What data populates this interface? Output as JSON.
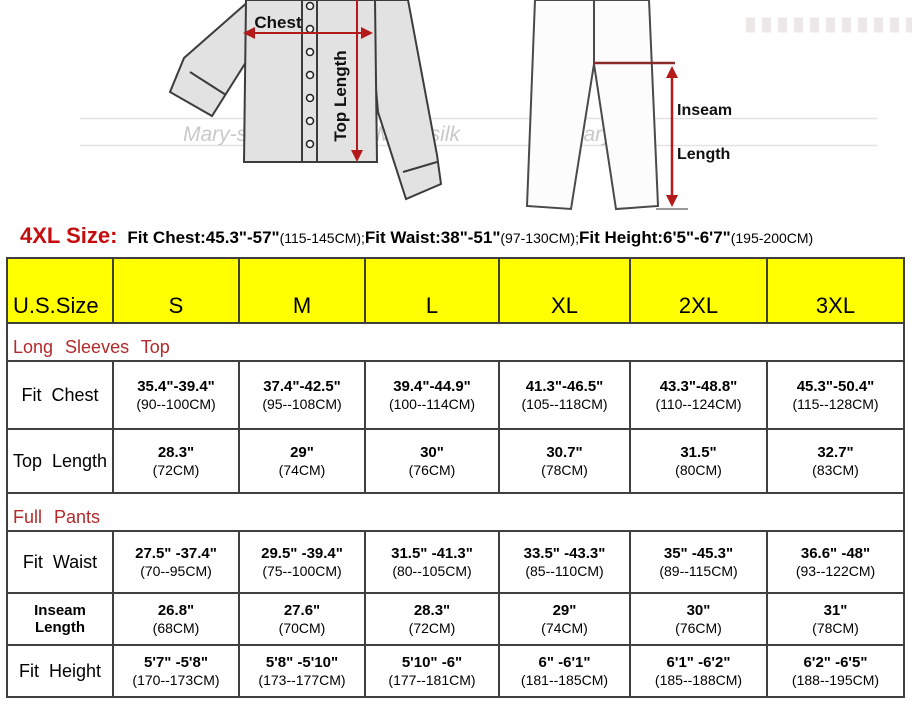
{
  "colors": {
    "header_bg": "#ffff00",
    "arrow_red": "#b51a1a",
    "crotch_line": "#8a2a2a",
    "section_title_red": "#b22a2a",
    "note_prefix_red": "#c60d0d"
  },
  "illustration": {
    "chest_label": "Chest",
    "top_length_label": "Top Length",
    "inseam_label_line1": "Inseam",
    "inseam_label_line2": "Length",
    "watermark": "Mary-silk"
  },
  "size_note": {
    "prefix": "4XL Size:",
    "segments": [
      {
        "bold": "Fit Chest:45.3\"-57\"",
        "normal": "(115-145CM);"
      },
      {
        "bold": "Fit Waist:38\"-51\"",
        "normal": "(97-130CM);"
      },
      {
        "bold": "Fit Height:6'5\"-6'7\"",
        "normal": "(195-200CM)"
      }
    ]
  },
  "table": {
    "header": [
      "U.S.Size",
      "S",
      "M",
      "L",
      "XL",
      "2XL",
      "3XL"
    ],
    "section1_title": "Long Sleeves Top",
    "section2_title": "Full Pants",
    "rows": [
      {
        "label": "Fit Chest",
        "values": [
          [
            "35.4\"-39.4\"",
            "(90--100CM)"
          ],
          [
            "37.4\"-42.5\"",
            "(95--108CM)"
          ],
          [
            "39.4\"-44.9\"",
            "(100--114CM)"
          ],
          [
            "41.3\"-46.5\"",
            "(105--118CM)"
          ],
          [
            "43.3\"-48.8\"",
            "(110--124CM)"
          ],
          [
            "45.3\"-50.4\"",
            "(115--128CM)"
          ]
        ]
      },
      {
        "label": "Top Length",
        "values": [
          [
            "28.3\"",
            "(72CM)"
          ],
          [
            "29\"",
            "(74CM)"
          ],
          [
            "30\"",
            "(76CM)"
          ],
          [
            "30.7\"",
            "(78CM)"
          ],
          [
            "31.5\"",
            "(80CM)"
          ],
          [
            "32.7\"",
            "(83CM)"
          ]
        ]
      },
      {
        "label": "Fit Waist",
        "values": [
          [
            "27.5\" -37.4\"",
            "(70--95CM)"
          ],
          [
            "29.5\" -39.4\"",
            "(75--100CM)"
          ],
          [
            "31.5\" -41.3\"",
            "(80--105CM)"
          ],
          [
            "33.5\" -43.3\"",
            "(85--110CM)"
          ],
          [
            "35\" -45.3\"",
            "(89--115CM)"
          ],
          [
            "36.6\" -48\"",
            "(93--122CM)"
          ]
        ]
      },
      {
        "label": "Inseam Length",
        "values": [
          [
            "26.8\"",
            "(68CM)"
          ],
          [
            "27.6\"",
            "(70CM)"
          ],
          [
            "28.3\"",
            "(72CM)"
          ],
          [
            "29\"",
            "(74CM)"
          ],
          [
            "30\"",
            "(76CM)"
          ],
          [
            "31\"",
            "(78CM)"
          ]
        ]
      },
      {
        "label": "Fit Height",
        "values": [
          [
            "5'7\" -5'8\"",
            "(170--173CM)"
          ],
          [
            "5'8\" -5'10\"",
            "(173--177CM)"
          ],
          [
            "5'10\" -6\"",
            "(177--181CM)"
          ],
          [
            "6\" -6'1\"",
            "(181--185CM)"
          ],
          [
            "6'1\" -6'2\"",
            "(185--188CM)"
          ],
          [
            "6'2\" -6'5\"",
            "(188--195CM)"
          ]
        ]
      }
    ]
  }
}
